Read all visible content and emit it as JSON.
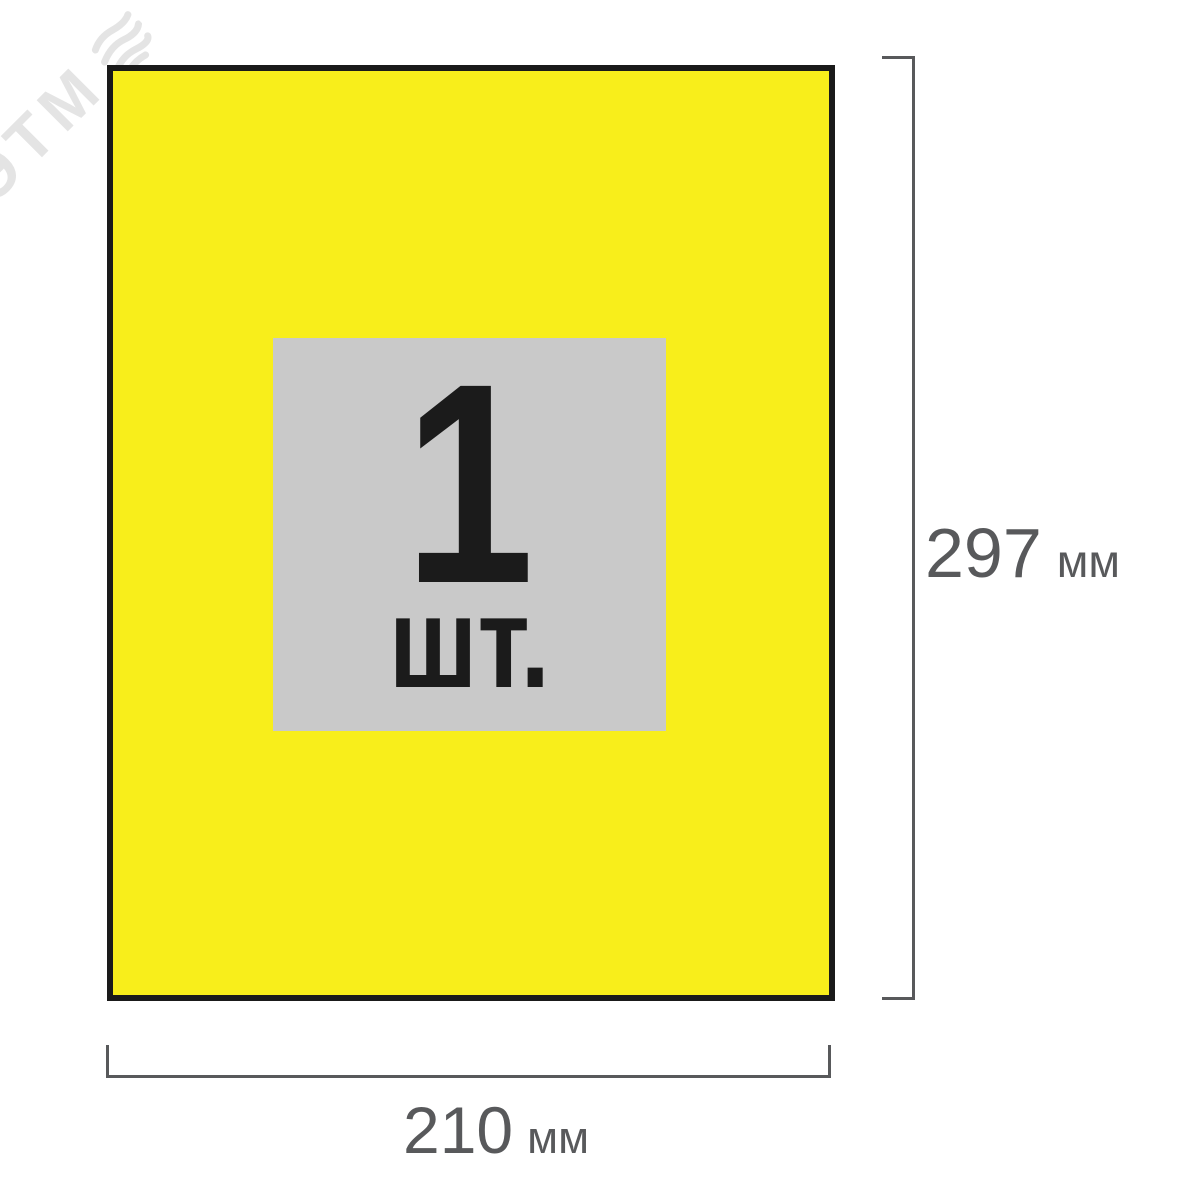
{
  "watermark": {
    "text": "ЭТМ",
    "logo": "etm-stripes-logo"
  },
  "product_sheet": {
    "count": "1",
    "unit": "шт.",
    "description": "Yellow A4 self-adhesive label sheet, 1 label per sheet"
  },
  "dimensions": {
    "height": {
      "value": "297",
      "unit": "мм"
    },
    "width": {
      "value": "210",
      "unit": "мм"
    }
  },
  "colors": {
    "background": "#FFFFFF",
    "sheet_fill": "#F8EE1B",
    "sheet_border": "#1A1A1A",
    "badge_fill": "#C9C9C9",
    "count_text": "#1B1B1B",
    "dimension": "#58595B",
    "watermark": "#E4E4E4"
  }
}
